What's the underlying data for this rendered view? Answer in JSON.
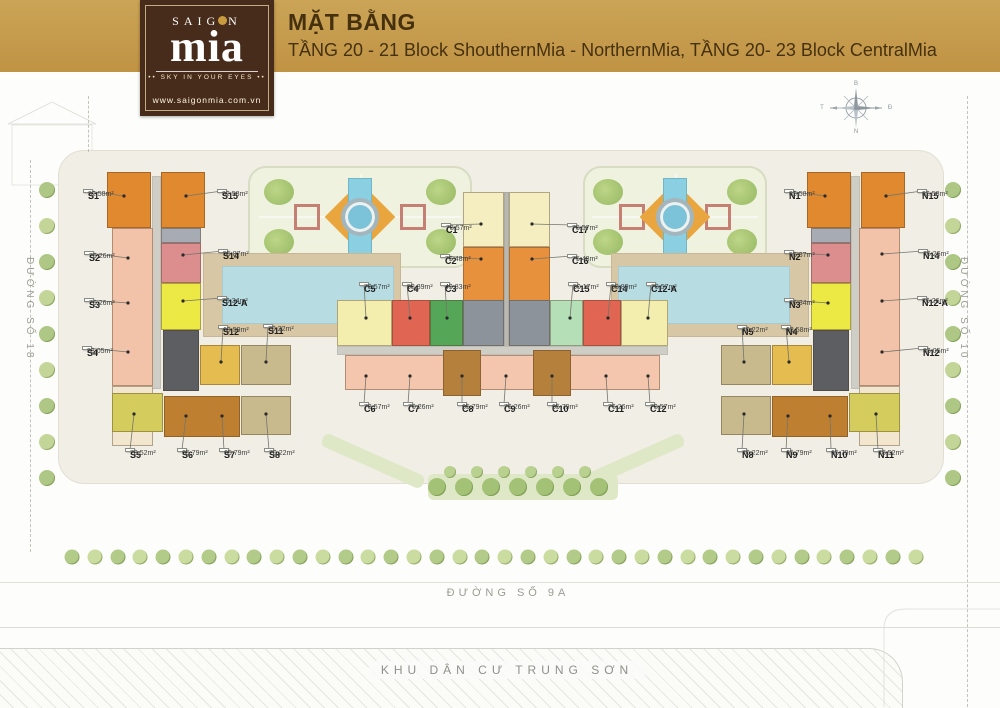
{
  "header": {
    "title": "MẶT BẰNG",
    "subtitle": "TẦNG 20 - 21 Block ShouthernMia - NorthernMia, TẦNG 20- 23 Block CentralMia"
  },
  "logo": {
    "name_pre": "SAIG",
    "name_post": "N",
    "name_main": "mia",
    "dots": "••",
    "tagline": "SKY IN YOUR EYES",
    "url": "www.saigonmia.com.vn"
  },
  "streets": {
    "left": "ĐƯỜNG SỐ 18",
    "right": "ĐƯỜNG SỐ 10",
    "bottom": "ĐƯỜNG SỐ 9A",
    "district": "KHU DÂN CƯ TRUNG SƠN"
  },
  "compass": {
    "north": "B",
    "east": "Đ",
    "south": "N",
    "west": "T"
  },
  "plan": {
    "units": [
      {
        "id": "S1",
        "area": "82,58m²",
        "lx": 88,
        "ly": 191,
        "tx": 124,
        "ty": 196
      },
      {
        "id": "S15",
        "area": "82,58m²",
        "lx": 222,
        "ly": 191,
        "tx": 186,
        "ty": 196
      },
      {
        "id": "S2",
        "area": "76,26m²",
        "lx": 89,
        "ly": 253,
        "tx": 128,
        "ty": 258
      },
      {
        "id": "S14",
        "area": "55,87m²",
        "lx": 223,
        "ly": 251,
        "tx": 183,
        "ty": 255
      },
      {
        "id": "S3",
        "area": "76,26m²",
        "lx": 89,
        "ly": 300,
        "tx": 128,
        "ty": 303
      },
      {
        "id": "S12-A",
        "area": "76,34m²",
        "lx": 222,
        "ly": 298,
        "tx": 183,
        "ty": 301
      },
      {
        "id": "S12",
        "area": "63,59m²",
        "lx": 223,
        "ly": 327,
        "tx": 221,
        "ty": 362
      },
      {
        "id": "S11",
        "area": "70,22m²",
        "lx": 268,
        "ly": 326,
        "tx": 266,
        "ty": 362
      },
      {
        "id": "S4",
        "area": "83,05m²",
        "lx": 87,
        "ly": 348,
        "tx": 128,
        "ty": 352
      },
      {
        "id": "S5",
        "area": "78,52m²",
        "lx": 130,
        "ly": 450,
        "tx": 134,
        "ty": 414
      },
      {
        "id": "S6",
        "area": "65,79m²",
        "lx": 182,
        "ly": 450,
        "tx": 186,
        "ty": 416
      },
      {
        "id": "S7",
        "area": "65,79m²",
        "lx": 224,
        "ly": 450,
        "tx": 222,
        "ty": 416
      },
      {
        "id": "S8",
        "area": "70,22m²",
        "lx": 269,
        "ly": 450,
        "tx": 266,
        "ty": 414
      },
      {
        "id": "C1",
        "area": "78,57m²",
        "lx": 446,
        "ly": 225,
        "tx": 481,
        "ty": 224
      },
      {
        "id": "C17",
        "area": "78,57m²",
        "lx": 572,
        "ly": 225,
        "tx": 532,
        "ty": 224
      },
      {
        "id": "C2",
        "area": "75,48m²",
        "lx": 445,
        "ly": 256,
        "tx": 481,
        "ty": 259
      },
      {
        "id": "C16",
        "area": "75,48m²",
        "lx": 572,
        "ly": 256,
        "tx": 532,
        "ty": 259
      },
      {
        "id": "C5",
        "area": "78,57m²",
        "lx": 364,
        "ly": 284,
        "tx": 366,
        "ty": 318
      },
      {
        "id": "C4",
        "area": "58,89m²",
        "lx": 407,
        "ly": 284,
        "tx": 410,
        "ty": 318
      },
      {
        "id": "C3",
        "area": "49,83m²",
        "lx": 445,
        "ly": 284,
        "tx": 447,
        "ty": 318
      },
      {
        "id": "C15",
        "area": "50,17m²",
        "lx": 573,
        "ly": 284,
        "tx": 570,
        "ty": 318
      },
      {
        "id": "C14",
        "area": "58,89m²",
        "lx": 611,
        "ly": 284,
        "tx": 608,
        "ty": 318
      },
      {
        "id": "C12-A",
        "area": "78,57m²",
        "lx": 651,
        "ly": 284,
        "tx": 648,
        "ty": 318
      },
      {
        "id": "C6",
        "area": "78,57m²",
        "lx": 364,
        "ly": 404,
        "tx": 366,
        "ty": 376
      },
      {
        "id": "C7",
        "area": "76,26m²",
        "lx": 408,
        "ly": 404,
        "tx": 410,
        "ty": 376
      },
      {
        "id": "C8",
        "area": "65,79m²",
        "lx": 462,
        "ly": 404,
        "tx": 462,
        "ty": 376
      },
      {
        "id": "C9",
        "area": "76,26m²",
        "lx": 504,
        "ly": 404,
        "tx": 506,
        "ty": 376
      },
      {
        "id": "C10",
        "area": "65,79m²",
        "lx": 552,
        "ly": 404,
        "tx": 552,
        "ty": 376
      },
      {
        "id": "C11",
        "area": "76,26m²",
        "lx": 608,
        "ly": 404,
        "tx": 606,
        "ty": 376
      },
      {
        "id": "C12",
        "area": "78,57m²",
        "lx": 650,
        "ly": 404,
        "tx": 648,
        "ty": 376
      },
      {
        "id": "N1",
        "area": "82,58m²",
        "lx": 789,
        "ly": 191,
        "tx": 825,
        "ty": 196
      },
      {
        "id": "N15",
        "area": "82,58m²",
        "lx": 922,
        "ly": 191,
        "tx": 886,
        "ty": 196
      },
      {
        "id": "N2",
        "area": "55,87m²",
        "lx": 789,
        "ly": 252,
        "tx": 828,
        "ty": 255
      },
      {
        "id": "N14",
        "area": "76,26m²",
        "lx": 923,
        "ly": 251,
        "tx": 882,
        "ty": 254
      },
      {
        "id": "N3",
        "area": "76,34m²",
        "lx": 789,
        "ly": 300,
        "tx": 828,
        "ty": 303
      },
      {
        "id": "N12-A",
        "area": "76,26m²",
        "lx": 922,
        "ly": 298,
        "tx": 882,
        "ty": 301
      },
      {
        "id": "N5",
        "area": "70,22m²",
        "lx": 742,
        "ly": 327,
        "tx": 744,
        "ty": 362
      },
      {
        "id": "N4",
        "area": "63,58m²",
        "lx": 786,
        "ly": 327,
        "tx": 789,
        "ty": 362
      },
      {
        "id": "N12",
        "area": "83,05m²",
        "lx": 923,
        "ly": 348,
        "tx": 882,
        "ty": 352
      },
      {
        "id": "N8",
        "area": "70,22m²",
        "lx": 742,
        "ly": 450,
        "tx": 744,
        "ty": 414
      },
      {
        "id": "N9",
        "area": "65,79m²",
        "lx": 786,
        "ly": 450,
        "tx": 788,
        "ty": 416
      },
      {
        "id": "N10",
        "area": "65,79m²",
        "lx": 831,
        "ly": 450,
        "tx": 830,
        "ty": 416
      },
      {
        "id": "N11",
        "area": "78,52m²",
        "lx": 878,
        "ly": 450,
        "tx": 876,
        "ty": 414
      }
    ],
    "blocks": [
      {
        "name": "south-pool-deck",
        "x": 203,
        "y": 253,
        "w": 198,
        "h": 84,
        "c": "#d8c7a4",
        "flat": true
      },
      {
        "name": "south-pool",
        "x": 222,
        "y": 266,
        "w": 172,
        "h": 58,
        "c": "#b7dce2",
        "flat": true
      },
      {
        "name": "north-pool-deck",
        "x": 611,
        "y": 253,
        "w": 198,
        "h": 84,
        "c": "#d8c7a4",
        "flat": true
      },
      {
        "name": "north-pool",
        "x": 618,
        "y": 266,
        "w": 172,
        "h": 58,
        "c": "#b7dce2",
        "flat": true
      },
      {
        "name": "s1-tower",
        "x": 107,
        "y": 172,
        "w": 44,
        "h": 56,
        "c": "#e0892f"
      },
      {
        "name": "s15-tower",
        "x": 161,
        "y": 172,
        "w": 44,
        "h": 56,
        "c": "#e0892f"
      },
      {
        "name": "s-spine",
        "x": 152,
        "y": 176,
        "w": 9,
        "h": 213,
        "c": "#cfcec6",
        "flat": true
      },
      {
        "name": "s2-s3-slab",
        "x": 112,
        "y": 228,
        "w": 41,
        "h": 158,
        "c": "#f2c3a9"
      },
      {
        "name": "s4-slab",
        "x": 112,
        "y": 386,
        "w": 41,
        "h": 60,
        "c": "#f3e6cf"
      },
      {
        "name": "s-gray-seg",
        "x": 161,
        "y": 228,
        "w": 40,
        "h": 15,
        "c": "#a7acb4"
      },
      {
        "name": "s14-block",
        "x": 161,
        "y": 243,
        "w": 40,
        "h": 40,
        "c": "#dc8e8e"
      },
      {
        "name": "s12a-block",
        "x": 161,
        "y": 283,
        "w": 40,
        "h": 47,
        "c": "#ece945"
      },
      {
        "name": "s-core",
        "x": 163,
        "y": 330,
        "w": 36,
        "h": 61,
        "c": "#5c5e62"
      },
      {
        "name": "s12-block",
        "x": 200,
        "y": 345,
        "w": 40,
        "h": 40,
        "c": "#e4bc50"
      },
      {
        "name": "s11-block",
        "x": 241,
        "y": 345,
        "w": 50,
        "h": 40,
        "c": "#c9ba8e"
      },
      {
        "name": "s5-block",
        "x": 112,
        "y": 393,
        "w": 51,
        "h": 39,
        "c": "#d4cc5c"
      },
      {
        "name": "s6-s7-block",
        "x": 164,
        "y": 396,
        "w": 76,
        "h": 41,
        "c": "#bf7f30"
      },
      {
        "name": "s8-block",
        "x": 241,
        "y": 396,
        "w": 50,
        "h": 39,
        "c": "#c9ba8e"
      },
      {
        "name": "c1-tower",
        "x": 463,
        "y": 192,
        "w": 41,
        "h": 55,
        "c": "#f4eec0"
      },
      {
        "name": "c17-tower",
        "x": 509,
        "y": 192,
        "w": 41,
        "h": 55,
        "c": "#f4eec0"
      },
      {
        "name": "c-spine",
        "x": 504,
        "y": 192,
        "w": 5,
        "h": 163,
        "c": "#b9b9b1",
        "flat": true
      },
      {
        "name": "c2-segment",
        "x": 463,
        "y": 247,
        "w": 41,
        "h": 88,
        "c": "#e8913d"
      },
      {
        "name": "c16-segment",
        "x": 509,
        "y": 247,
        "w": 41,
        "h": 88,
        "c": "#e8913d"
      },
      {
        "name": "c-mid-west-wing",
        "x": 337,
        "y": 300,
        "w": 55,
        "h": 46,
        "c": "#f3edae"
      },
      {
        "name": "c4-block",
        "x": 392,
        "y": 300,
        "w": 38,
        "h": 46,
        "c": "#e06552"
      },
      {
        "name": "c3-block",
        "x": 430,
        "y": 300,
        "w": 33,
        "h": 46,
        "c": "#55a757"
      },
      {
        "name": "c-core-west",
        "x": 463,
        "y": 300,
        "w": 41,
        "h": 46,
        "c": "#8d939b"
      },
      {
        "name": "c-core-east",
        "x": 509,
        "y": 300,
        "w": 41,
        "h": 46,
        "c": "#8d939b"
      },
      {
        "name": "c15-block",
        "x": 550,
        "y": 300,
        "w": 33,
        "h": 46,
        "c": "#b5dfb7"
      },
      {
        "name": "c14-block",
        "x": 583,
        "y": 300,
        "w": 38,
        "h": 46,
        "c": "#e06552"
      },
      {
        "name": "c-mid-east-wing",
        "x": 621,
        "y": 300,
        "w": 47,
        "h": 46,
        "c": "#f3edae"
      },
      {
        "name": "c-corridor",
        "x": 337,
        "y": 346,
        "w": 331,
        "h": 9,
        "c": "#cfcec6",
        "flat": true
      },
      {
        "name": "c-south-band",
        "x": 345,
        "y": 355,
        "w": 315,
        "h": 35,
        "c": "#f4c6ad"
      },
      {
        "name": "c8-tower",
        "x": 443,
        "y": 350,
        "w": 38,
        "h": 46,
        "c": "#b5803c"
      },
      {
        "name": "c10-tower",
        "x": 533,
        "y": 350,
        "w": 38,
        "h": 46,
        "c": "#b5803c"
      },
      {
        "name": "n1-tower",
        "x": 807,
        "y": 172,
        "w": 44,
        "h": 56,
        "c": "#e0892f"
      },
      {
        "name": "n15-tower",
        "x": 861,
        "y": 172,
        "w": 44,
        "h": 56,
        "c": "#e0892f"
      },
      {
        "name": "n-spine",
        "x": 851,
        "y": 176,
        "w": 9,
        "h": 213,
        "c": "#cfcec6",
        "flat": true
      },
      {
        "name": "n14-n12a-slab",
        "x": 859,
        "y": 228,
        "w": 41,
        "h": 158,
        "c": "#f2c3a9"
      },
      {
        "name": "n12-slab",
        "x": 859,
        "y": 386,
        "w": 41,
        "h": 60,
        "c": "#f3e6cf"
      },
      {
        "name": "n-gray-seg",
        "x": 811,
        "y": 228,
        "w": 40,
        "h": 15,
        "c": "#a7acb4"
      },
      {
        "name": "n2-block",
        "x": 811,
        "y": 243,
        "w": 40,
        "h": 40,
        "c": "#dc8e8e"
      },
      {
        "name": "n3-block",
        "x": 811,
        "y": 283,
        "w": 40,
        "h": 47,
        "c": "#ece945"
      },
      {
        "name": "n-core",
        "x": 813,
        "y": 330,
        "w": 36,
        "h": 61,
        "c": "#5c5e62"
      },
      {
        "name": "n4-block",
        "x": 772,
        "y": 345,
        "w": 40,
        "h": 40,
        "c": "#e4bc50"
      },
      {
        "name": "n5-block",
        "x": 721,
        "y": 345,
        "w": 50,
        "h": 40,
        "c": "#c9ba8e"
      },
      {
        "name": "n11-block",
        "x": 849,
        "y": 393,
        "w": 51,
        "h": 39,
        "c": "#d4cc5c"
      },
      {
        "name": "n9-n10-block",
        "x": 772,
        "y": 396,
        "w": 76,
        "h": 41,
        "c": "#bf7f30"
      },
      {
        "name": "n8-block",
        "x": 721,
        "y": 396,
        "w": 50,
        "h": 39,
        "c": "#c9ba8e"
      }
    ],
    "gardens": [
      {
        "name": "garden-west",
        "x": 248,
        "y": 166,
        "w": 224,
        "h": 102
      },
      {
        "name": "garden-east",
        "x": 583,
        "y": 166,
        "w": 184,
        "h": 102
      }
    ]
  }
}
